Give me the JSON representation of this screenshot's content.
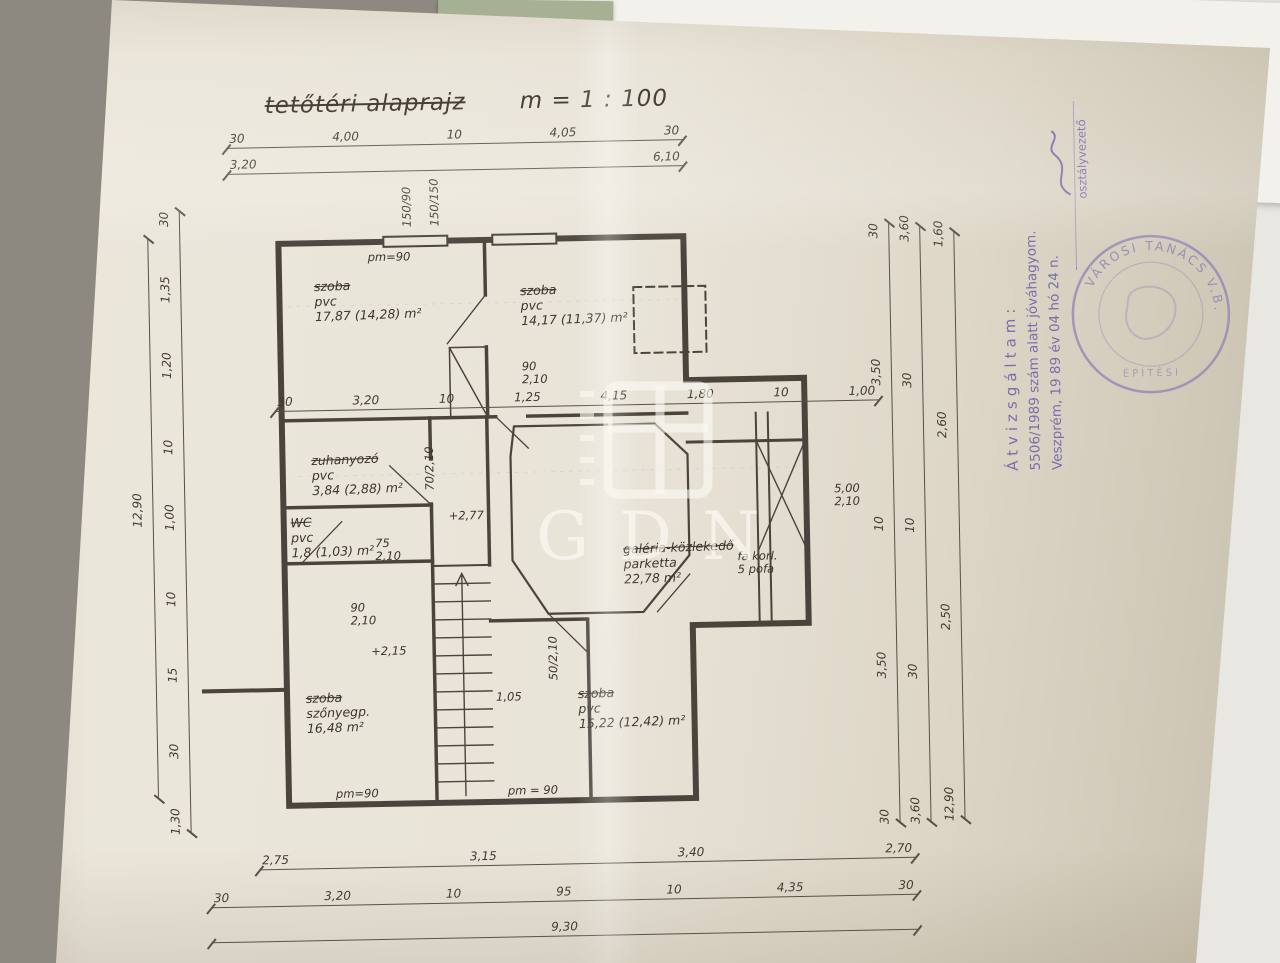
{
  "photo": {
    "watermark": {
      "text": "GDN"
    },
    "underlying_document": {
      "fragments": [
        "3265/",
        "3326/",
        "..donos  Fe..",
        "Jogosult neve: Bakonyi Fe..",
        "Címe: 8200 VESZP..",
        "határozat: 332.."
      ]
    }
  },
  "title": {
    "text": "tetőtéri alaprajz",
    "scale": "m = 1 : 100"
  },
  "rooms": [
    {
      "name": "szoba",
      "floor": "pvc",
      "area": "17,87 (14,28) m²"
    },
    {
      "name": "szoba",
      "floor": "pvc",
      "area": "14,17 (11,37) m²"
    },
    {
      "name": "zuhanyozó",
      "floor": "pvc",
      "area": "3,84 (2,88) m²"
    },
    {
      "name": "WC",
      "floor": "pvc",
      "area": "1,8 (1,03) m²"
    },
    {
      "name": "galéria-közlekedő",
      "floor": "parketta",
      "area": "22,78 m²"
    },
    {
      "name": "szoba",
      "floor": "szőnyegp.",
      "area": "16,48 m²"
    },
    {
      "name": "szoba",
      "floor": "pvc",
      "area": "15,22 (12,42) m²"
    }
  ],
  "annotations": {
    "window_1": "150/90",
    "window_2": "150/150",
    "parapet_1": "pm=90",
    "parapet_2": "pm=90",
    "parapet_3": "pm = 90",
    "door_top_w": "90",
    "door_top_h": "2,10",
    "shower_door": "70/2,10",
    "wc_door_w": "75",
    "wc_door_h": "2,10",
    "level_1": "+2,77",
    "hall_door_w": "90",
    "hall_door_h": "2,10",
    "level_2": "+2,15",
    "stair_door": "50/2,10",
    "landing_width": "1,05",
    "right_opening_w": "5,00",
    "right_opening_h": "2,10",
    "railing_1": "fa korl.",
    "railing_2": "5 pofa"
  },
  "dims": {
    "top_row1": [
      "30",
      "4,00",
      "10",
      "4,05",
      "30"
    ],
    "top_row2": [
      "3,20",
      "6,10"
    ],
    "middle_row": [
      "30",
      "3,20",
      "10",
      "1,25",
      "4,15",
      "1,80",
      "10",
      "1,00"
    ],
    "bottom_row1": [
      "2,75",
      "3,15",
      "3,40",
      "2,70"
    ],
    "bottom_row2": [
      "30",
      "3,20",
      "10",
      "95",
      "10",
      "4,35",
      "30"
    ],
    "bottom_row3": [
      "9,30"
    ],
    "left_inner": [
      "30",
      "1,35",
      "1,20",
      "10",
      "1,00",
      "10",
      "15",
      "30",
      "1,30"
    ],
    "left_outer": [
      "12,90"
    ],
    "right_inner": [
      "30",
      "3,50",
      "10",
      "3,50",
      "30"
    ],
    "right_mid": [
      "3,60",
      "30",
      "10",
      "30",
      "3,60"
    ],
    "right_outer": [
      "1,60",
      "2,60",
      "2,50",
      "12,90"
    ]
  },
  "stamps": {
    "approval": {
      "line1": "Átvizsgáltam:",
      "line2": "5506/1989 szám alatt jóváhagyom.",
      "line3": "Veszprém, 19 89 év 04 hó 24 n.",
      "line4": "osztályvezető"
    },
    "round_seal": {
      "outer_text": "VÁROSI TANÁCS V.B.",
      "inner_text": "ÉPÍTÉSI"
    }
  }
}
